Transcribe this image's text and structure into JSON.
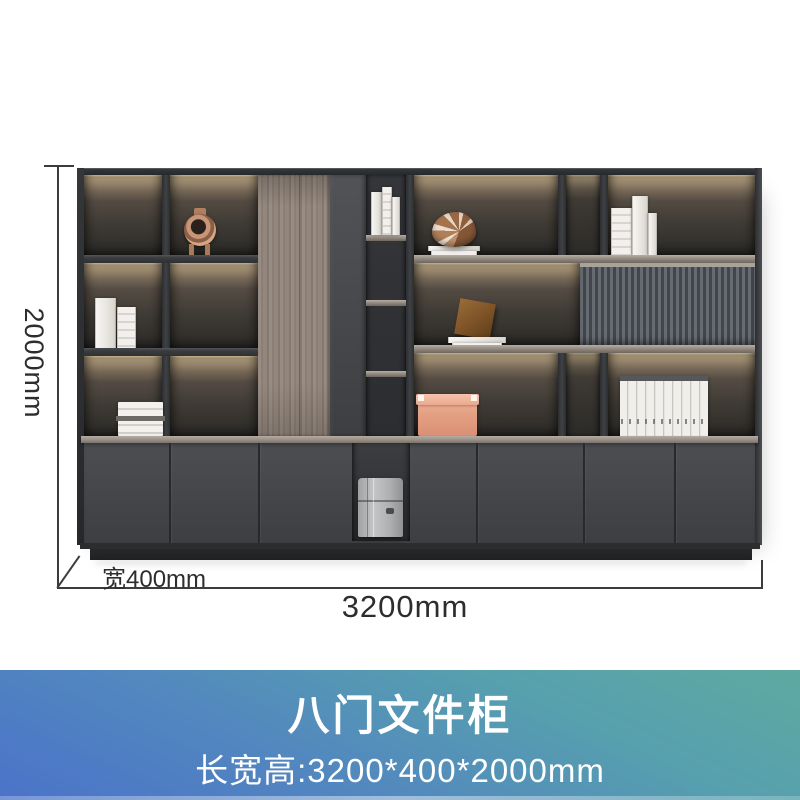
{
  "product": {
    "title": "八门文件柜",
    "subtitle": "长宽高:3200*400*2000mm"
  },
  "dimensions": {
    "height": "2000mm",
    "depth": "宽400mm",
    "width": "3200mm"
  },
  "banner": {
    "gradient_top_color": "#5ea9a2",
    "gradient_bottom_color": "#4b73c9",
    "text_color": "#ffffff"
  },
  "cabinet": {
    "description": "eight-door office filing bookcase, charcoal gray with LED shelf lighting",
    "colors": {
      "frame": "#2b2d30",
      "door_face": "#47494c",
      "wood_door": "#92867c",
      "fluted_panel": "#565a60",
      "counter_top": "#a1988f",
      "interior_glow": "#6e6155",
      "led_strip": "#ffe7bd",
      "plinth": "#232527"
    },
    "props": [
      "rose-gold-ornament",
      "white-books-left",
      "magazine-stack",
      "wood-grain-door",
      "cubby-books",
      "nautilus-shell-ornament",
      "white-books-top-right",
      "bronze-cube-ornament",
      "fluted-sliding-panel",
      "salmon-storage-box",
      "white-binder-row",
      "gray-briefcase"
    ]
  }
}
